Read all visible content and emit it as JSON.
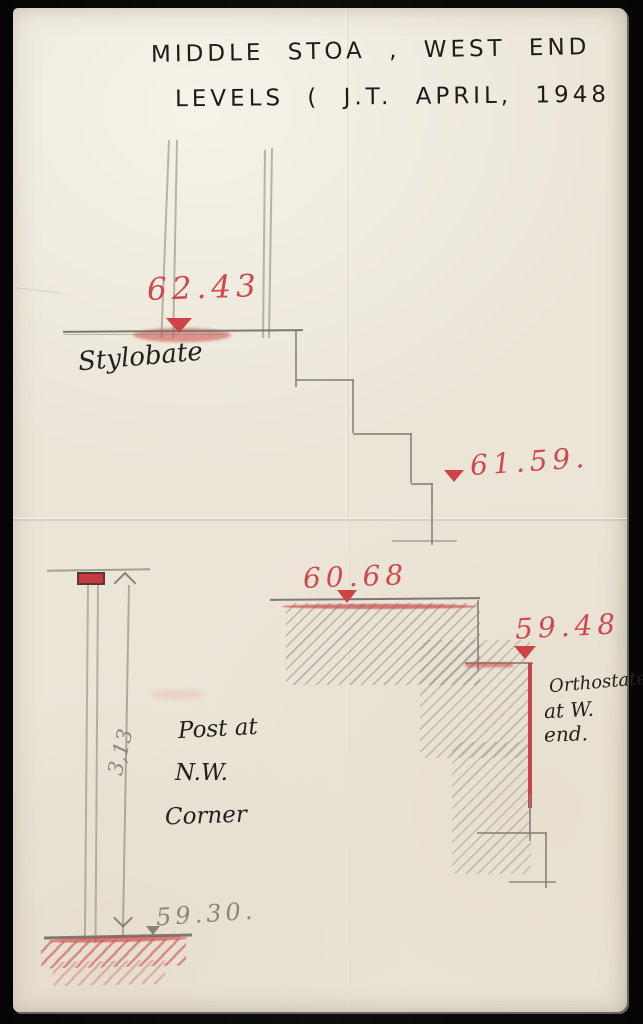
{
  "title": {
    "line1": "MIDDLE STOA , WEST END",
    "line2": "LEVELS ( J.T.  APRIL, 1948"
  },
  "levels": {
    "stylobate": "62.43",
    "steps_foot": "61.59.",
    "terrace": "60.68",
    "orthostate": "59.48",
    "ground": "59.30."
  },
  "labels": {
    "stylobate": "Stylobate",
    "orthostate_line1": "Orthostate",
    "orthostate_line2": "at W.",
    "orthostate_line3": "end.",
    "post_line1": "Post at",
    "post_line2": "N.W.",
    "post_line3": "Corner",
    "post_height": "3,13"
  },
  "colors": {
    "background": "#0b0b0b",
    "paper": "#ebe5d8",
    "red_ink": "#d0494d",
    "pencil": "#868278",
    "black_ink": "#23211d"
  }
}
